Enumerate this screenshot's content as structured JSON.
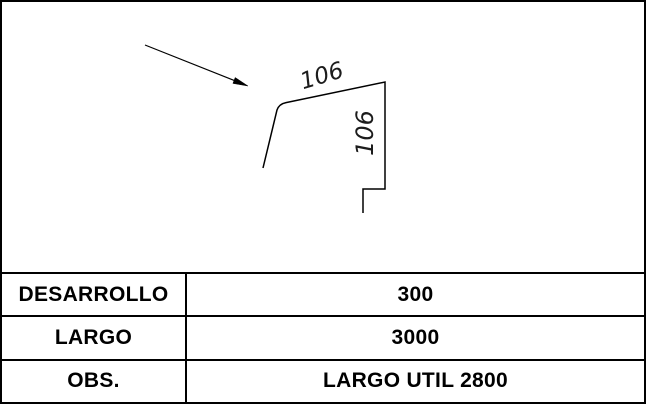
{
  "drawing": {
    "dim_top": "106",
    "dim_right": "106",
    "leader_arrow_icon": "arrow-pointing-down-right",
    "profile_description": "bent sheet-metal flashing profile, two 106 mm faces with end hems"
  },
  "table": {
    "rows": [
      {
        "label": "DESARROLLO",
        "value": "300"
      },
      {
        "label": "LARGO",
        "value": "3000"
      },
      {
        "label": "OBS.",
        "value": "LARGO UTIL 2800"
      }
    ]
  },
  "colors": {
    "line": "#000000",
    "background": "#ffffff",
    "text": "#000000"
  }
}
